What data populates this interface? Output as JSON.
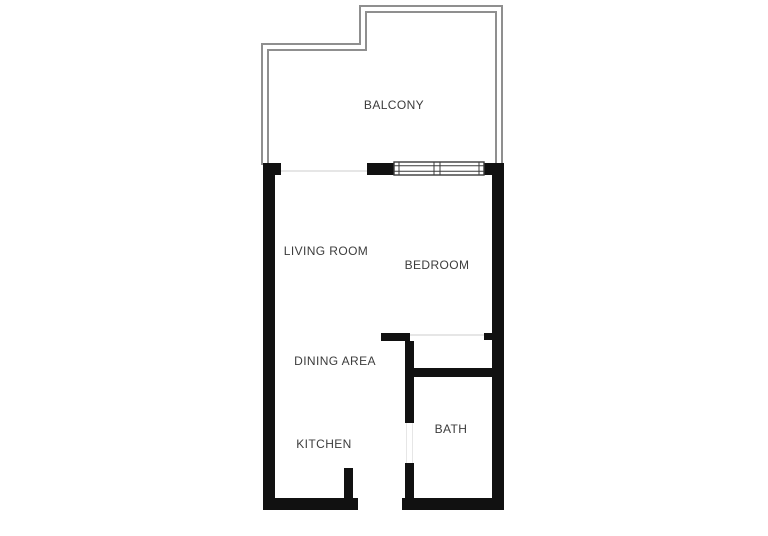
{
  "title": "Apartment floor plan",
  "theme": {
    "wall_color": "#111111",
    "railing_color": "#8f8f8f",
    "window_frame_color": "#3a3a3a",
    "opening_line_color": "#e6e6e6",
    "label_color": "#3c3c3c",
    "background": "#ffffff"
  },
  "rooms": {
    "balcony": {
      "label": "BALCONY"
    },
    "living_room": {
      "label": "LIVING ROOM"
    },
    "bedroom": {
      "label": "BEDROOM"
    },
    "dining_area": {
      "label": "DINING AREA"
    },
    "kitchen": {
      "label": "KITCHEN"
    },
    "bath": {
      "label": "BATH"
    }
  }
}
